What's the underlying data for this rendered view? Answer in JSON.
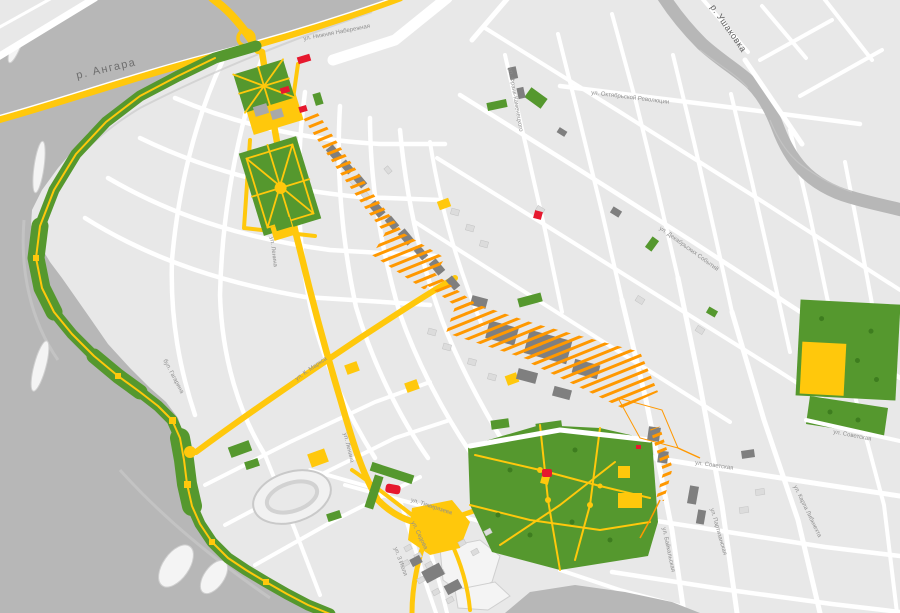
{
  "map": {
    "kind": "schematic city plan of central Irkutsk",
    "labels": [
      {
        "id": "river-angara",
        "text": "р. Ангара"
      },
      {
        "id": "river-ushakovka",
        "text": "р. Ушаковка"
      },
      {
        "id": "nizhnyaya-naberezhnaya",
        "text": "ул. Нижняя Набережная"
      },
      {
        "id": "oktyabrskoy-revolyutsii",
        "text": "ул. Октябрьской Революции"
      },
      {
        "id": "frank-kamenetskogo",
        "text": "ул. Франк-Каменецкого"
      },
      {
        "id": "dekabrskikh-sobytiy",
        "text": "ул. Декабрьских Событий"
      },
      {
        "id": "lenina",
        "text": "ул. Ленина"
      },
      {
        "id": "karla-marksa",
        "text": "ул. К. Маркса"
      },
      {
        "id": "bulvar-gagarina",
        "text": "бул. Гагарина"
      },
      {
        "id": "sovetskaya-1",
        "text": "ул. Советская"
      },
      {
        "id": "sovetskaya-2",
        "text": "ул. Советская"
      },
      {
        "id": "karla-libknekhta",
        "text": "ул. Карла Либкнехта"
      },
      {
        "id": "partizanskaya",
        "text": "ул. Партизанская"
      },
      {
        "id": "baykalskaya",
        "text": "ул. Байкальская"
      },
      {
        "id": "timiryazeva",
        "text": "ул. Тимирязева"
      },
      {
        "id": "sedova",
        "text": "ул. Седова"
      },
      {
        "id": "tretego-iyulya",
        "text": "ул. 3 Июля"
      },
      {
        "id": "lenina-2",
        "text": "ул. Ленина"
      }
    ]
  },
  "colors": {
    "water": "#b7b7b7",
    "land": "#e8e8e8",
    "street": "#ffffff",
    "park": "#55982e",
    "yellow": "#ffc80c",
    "orange": "#ff9800",
    "building": "#7f7f7f",
    "landmark": "#e6182e",
    "label": "#8f8f8f"
  }
}
